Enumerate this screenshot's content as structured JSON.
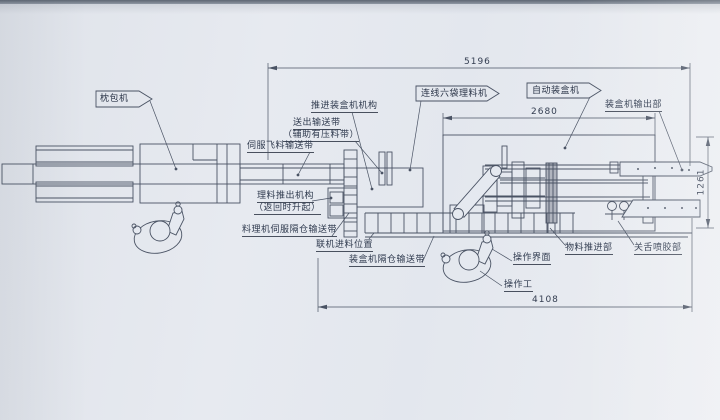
{
  "drawing": {
    "type": "engineering-layout-top-view",
    "subject": "pillow packer to automatic cartoner packaging line"
  },
  "colors": {
    "paper": "#e4e8ef",
    "ink": "#4a5364",
    "text": "#2f3a4e"
  },
  "flags": {
    "pillow_packer": "枕包机",
    "inline_organizer": "连线六袋理料机",
    "auto_cartoner": "自动装盒机"
  },
  "labels": {
    "push_mechanism": "推进装盒机机构",
    "outfeed_belt_line1": "送出输送带",
    "outfeed_belt_line2": "（辅助有压料带）",
    "servo_fly_belt": "伺服飞料输送带",
    "cartoner_output": "装盒机输出部",
    "pushout_line1": "理料推出机构",
    "pushout_line2": "（返回时升起）",
    "servo_compartment_belt": "料理机伺服隔仓输送带",
    "inline_feed_position": "联机进料位置",
    "cartoner_compartment_belt": "装盒机隔仓输送带",
    "operator_interface": "操作界面",
    "material_push_section": "物料推进部",
    "glue_section": "关舌喷胶部",
    "operator": "操作工"
  },
  "dimensions": {
    "overall_length": "5196",
    "cartoner_length": "2680",
    "machine_height": "1261",
    "floor_length": "4108"
  }
}
